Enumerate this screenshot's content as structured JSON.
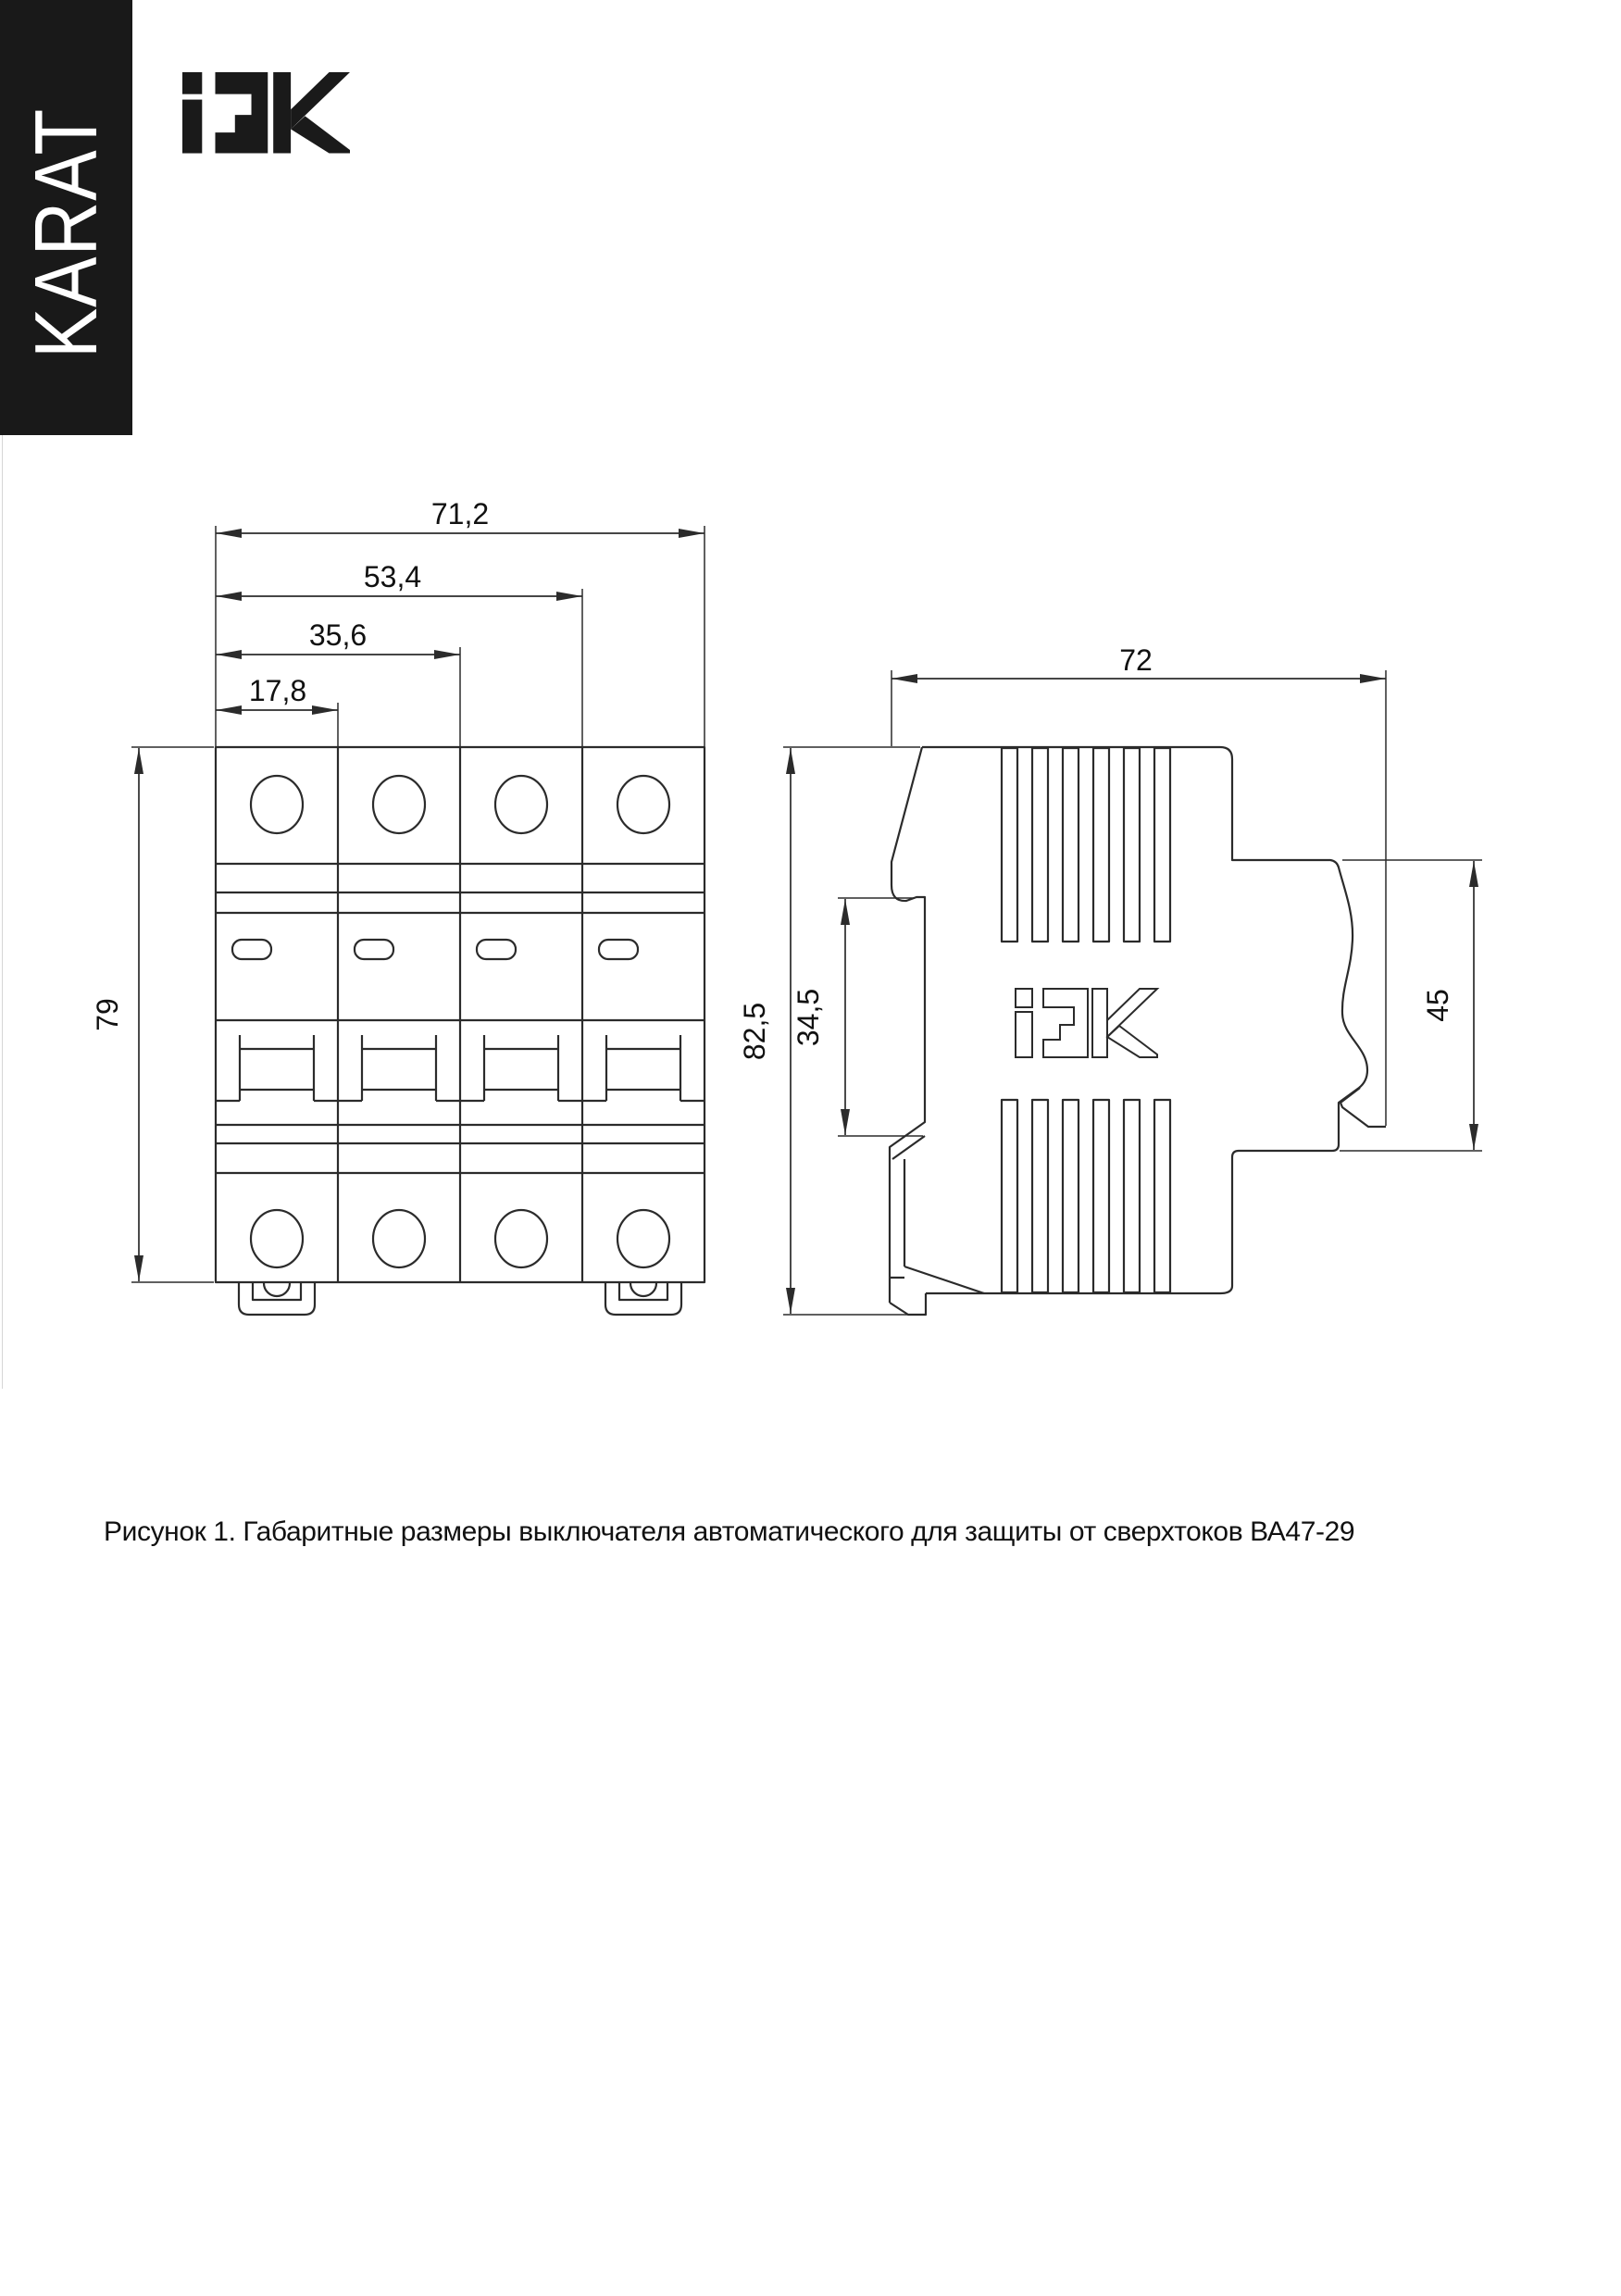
{
  "banner": {
    "label": "KARAT",
    "bg": "#191919",
    "text_color": "#ffffff"
  },
  "brand": {
    "name": "IEK",
    "logo_icon": "iek-logo",
    "color": "#1a1a1a"
  },
  "figure": {
    "caption": "Рисунок 1. Габаритные размеры выключателя автоматического для защиты от сверхтоков ВА47-29",
    "line_color": "#2b2b2b",
    "front_view": {
      "poles": 4,
      "dims": {
        "total_width": "71,2",
        "three_pole_width": "53,4",
        "two_pole_width": "35,6",
        "one_pole_width": "17,8",
        "height": "79"
      }
    },
    "side_view": {
      "logo": "IEK",
      "dims": {
        "depth": "72",
        "total_height": "82,5",
        "din_channel_height": "34,5",
        "terminal_zone_height": "45"
      }
    }
  }
}
